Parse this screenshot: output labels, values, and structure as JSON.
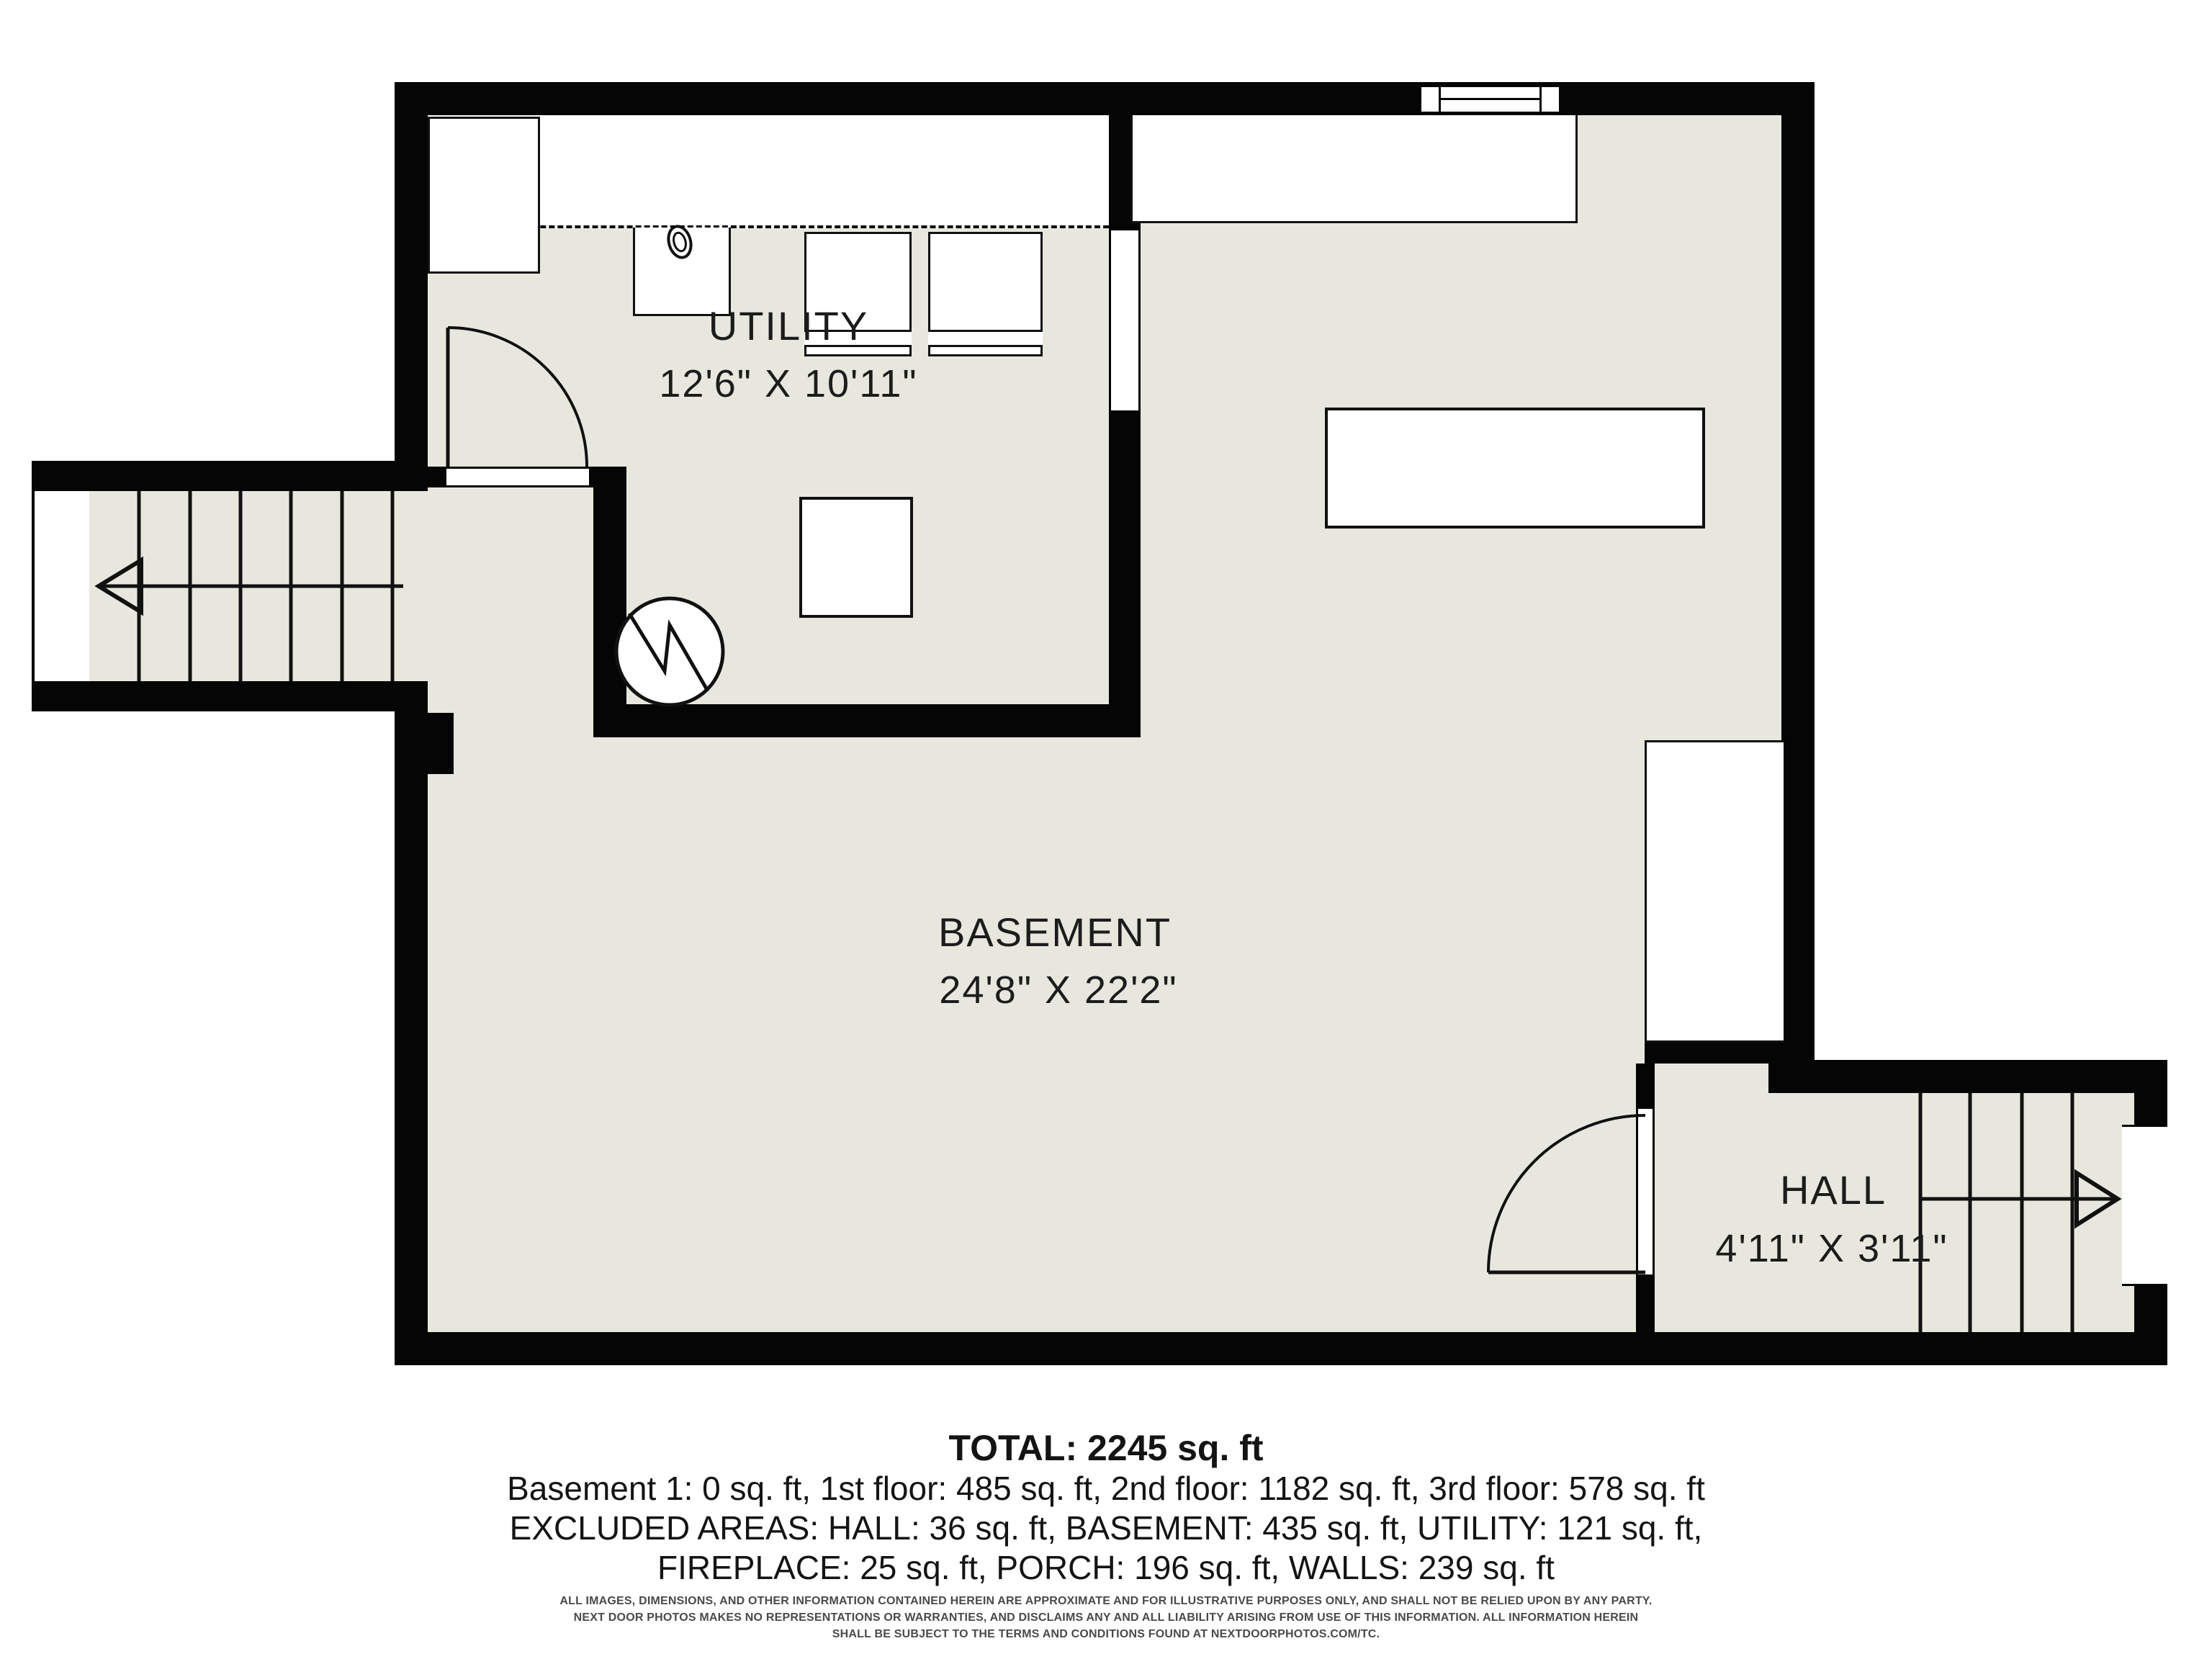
{
  "floorplan": {
    "rooms": [
      {
        "name": "UTILITY",
        "dimensions": "12'6\" X 10'11\""
      },
      {
        "name": "BASEMENT",
        "dimensions": "24'8\" X 22'2\""
      },
      {
        "name": "HALL",
        "dimensions": "4'11\" X 3'11\""
      }
    ],
    "stairs": [
      {
        "location": "left-wing",
        "arrow_direction": "left",
        "treads": 6
      },
      {
        "location": "hall-right",
        "arrow_direction": "right",
        "treads": 4
      }
    ],
    "colors": {
      "background": "#ffffff",
      "floor": "#e8e7dd",
      "wall": "#050505",
      "text": "#1c1c1c"
    }
  },
  "summary": {
    "total": "TOTAL: 2245 sq. ft",
    "floors": "Basement 1: 0 sq. ft, 1st floor: 485 sq. ft, 2nd floor: 1182 sq. ft, 3rd floor: 578 sq. ft",
    "excluded1": "EXCLUDED AREAS: HALL: 36 sq. ft, BASEMENT: 435 sq. ft, UTILITY: 121 sq. ft,",
    "excluded2": "FIREPLACE: 25 sq. ft, PORCH: 196 sq. ft, WALLS: 239 sq. ft"
  },
  "disclaimer": {
    "line1": "ALL IMAGES, DIMENSIONS, AND OTHER INFORMATION CONTAINED HEREIN ARE APPROXIMATE AND FOR ILLUSTRATIVE PURPOSES ONLY, AND SHALL NOT BE RELIED UPON BY ANY PARTY.",
    "line2": "NEXT DOOR PHOTOS MAKES NO REPRESENTATIONS OR WARRANTIES, AND DISCLAIMS ANY AND ALL LIABILITY ARISING FROM USE OF THIS INFORMATION. ALL INFORMATION HEREIN",
    "line3": "SHALL BE SUBJECT TO THE TERMS AND CONDITIONS FOUND AT NEXTDOORPHOTOS.COM/TC."
  }
}
